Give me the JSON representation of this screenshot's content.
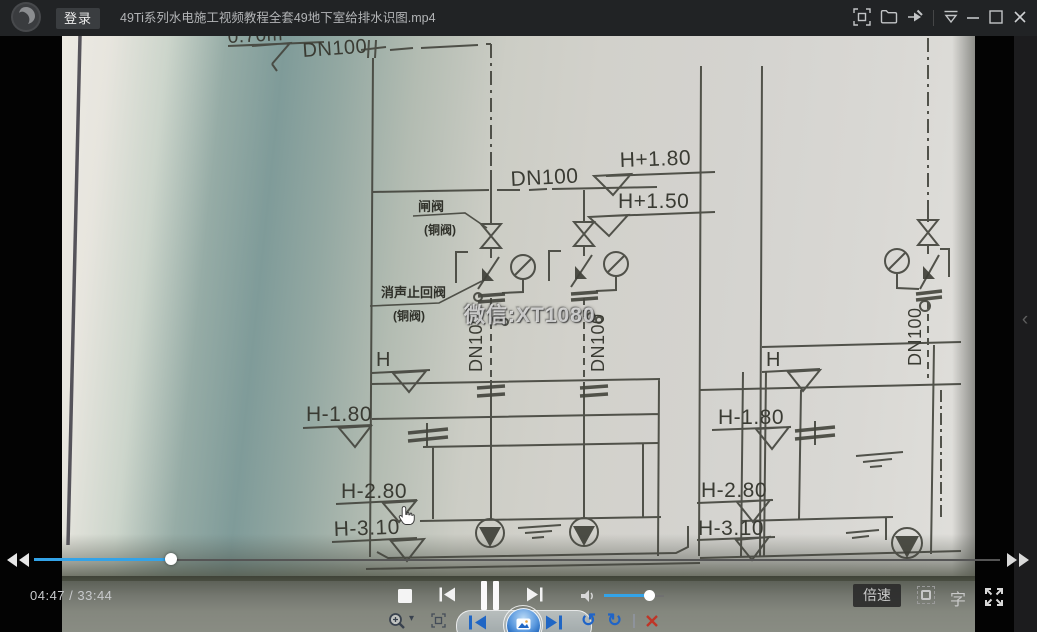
{
  "window": {
    "login_button": "登录",
    "title": "49Ti系列水电施工视频教程全套49地下室给排水识图.mp4"
  },
  "player": {
    "time_display": "04:47 / 33:44",
    "current_time": "04:47",
    "duration": "33:44",
    "progress_percent": 14.2,
    "volume_percent": 75,
    "speed_button": "倍速",
    "subtitle_button": "字",
    "accent_color": "#33a3e8",
    "chevron": "‹"
  },
  "video": {
    "watermark": "微信:XT1080"
  },
  "drawing": {
    "dim_top": "0.70m",
    "dn100_top": "DN100",
    "dn100_header": "DN100",
    "riser_a": "DN100",
    "riser_b": "DN100",
    "riser_c": "DN100",
    "elev_p180": "H+1.80",
    "elev_p150": "H+1.50",
    "h_left": "H",
    "h_right": "H",
    "left_m180": "H-1.80",
    "left_m280": "H-2.80",
    "left_m310": "H-3.10",
    "right_m180": "H-1.80",
    "right_m280": "H-2.80",
    "right_m310": "H-3.10",
    "valve1_name": "闸阀",
    "valve1_type": "(铜阀)",
    "valve2_name": "消声止回阀",
    "valve2_type": "(铜阀)"
  }
}
